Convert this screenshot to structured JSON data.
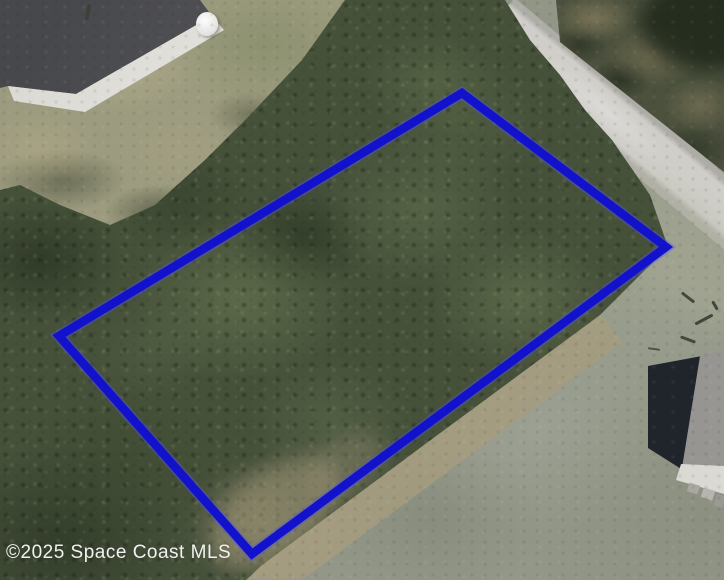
{
  "canvas": {
    "width": 724,
    "height": 580
  },
  "watermark": {
    "text": "©2025 Space Coast MLS",
    "color": "#f1f1ef"
  },
  "lot_boundary": {
    "shape": "quadrilateral",
    "color": "#1212cd",
    "glow_color": "#5257e0",
    "stroke_width": 8.5,
    "points": [
      [
        462,
        93
      ],
      [
        666,
        247
      ],
      [
        252,
        554
      ],
      [
        59,
        336
      ]
    ]
  },
  "scene": {
    "ground_color": "#8d9282",
    "tree_color": "#46513a",
    "lawn_color": "#9c9b7f",
    "road_color": "#c6c5c0",
    "features": [
      {
        "name": "house-with-gray-roof",
        "position": "top-left"
      },
      {
        "name": "white-tank",
        "position": "top-left"
      },
      {
        "name": "paved-street",
        "position": "top-right"
      },
      {
        "name": "wooded-vacant-lot",
        "position": "center"
      },
      {
        "name": "open-grass-field",
        "position": "bottom-right"
      },
      {
        "name": "house-with-shadow",
        "position": "bottom-right"
      }
    ]
  }
}
